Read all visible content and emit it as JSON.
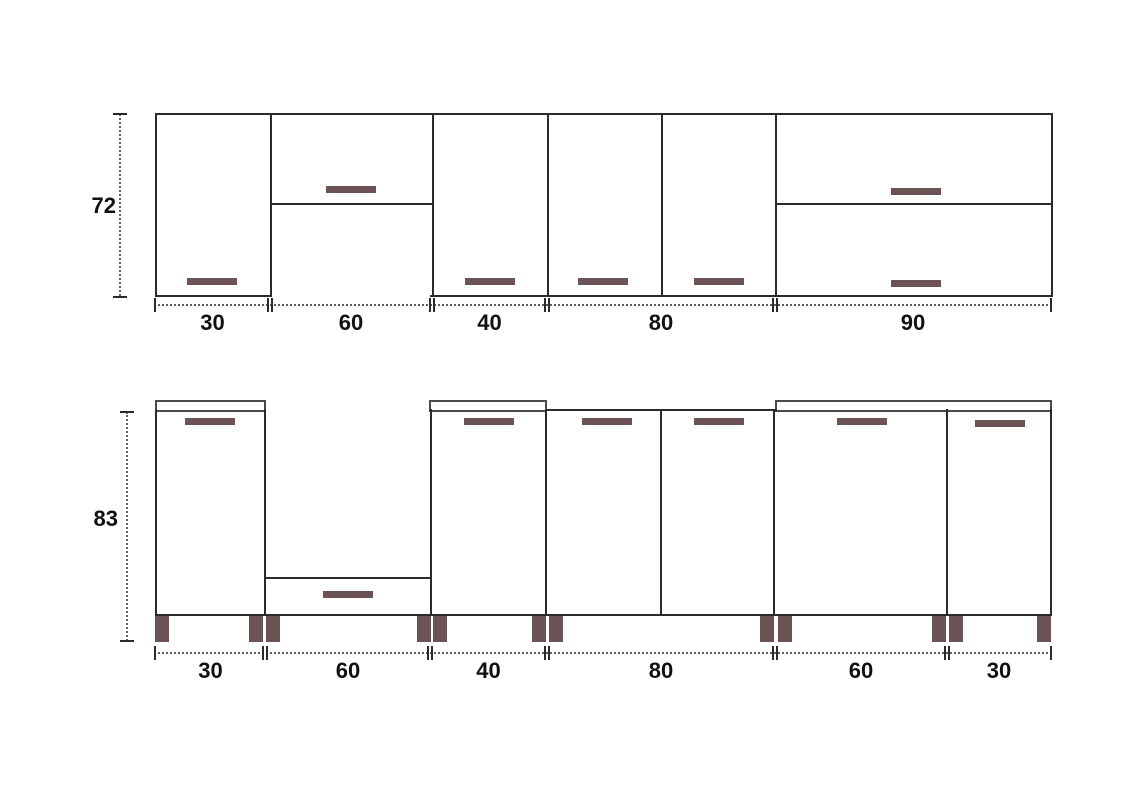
{
  "colors": {
    "background": "#ffffff",
    "outline": "#2b2b2b",
    "counter_outline": "#4a4a4a",
    "handle_and_leg": "#6c5456",
    "dimension_line": "#5f5f5f",
    "text": "#111111"
  },
  "wall_run": {
    "height_label": "72",
    "width_labels": [
      "30",
      "60",
      "40",
      "80",
      "90"
    ],
    "cabinets": [
      {
        "width": "30",
        "style": "single full-height door, handle at bottom"
      },
      {
        "width": "60",
        "style": "horizontal flip door above open niche"
      },
      {
        "width": "40",
        "style": "single full-height door, handle at bottom"
      },
      {
        "width": "80",
        "style": "two doors, handles at bottom"
      },
      {
        "width": "90",
        "style": "two stacked horizontal flip doors, centered handles"
      }
    ]
  },
  "base_run": {
    "height_label": "83",
    "width_labels": [
      "30",
      "60",
      "40",
      "80",
      "60",
      "30"
    ],
    "cabinets": [
      {
        "width": "30",
        "style": "single door under countertop, handle at top"
      },
      {
        "width": "60",
        "style": "open appliance gap with plinth drawer at bottom"
      },
      {
        "width": "40",
        "style": "single door under countertop, handle at top"
      },
      {
        "width": "80",
        "style": "two doors, handles at top, no countertop strip"
      },
      {
        "width": "60",
        "style": "single door under shared countertop, handle at top"
      },
      {
        "width": "30",
        "style": "single door under shared countertop, handle at top"
      }
    ],
    "legs": 12
  }
}
